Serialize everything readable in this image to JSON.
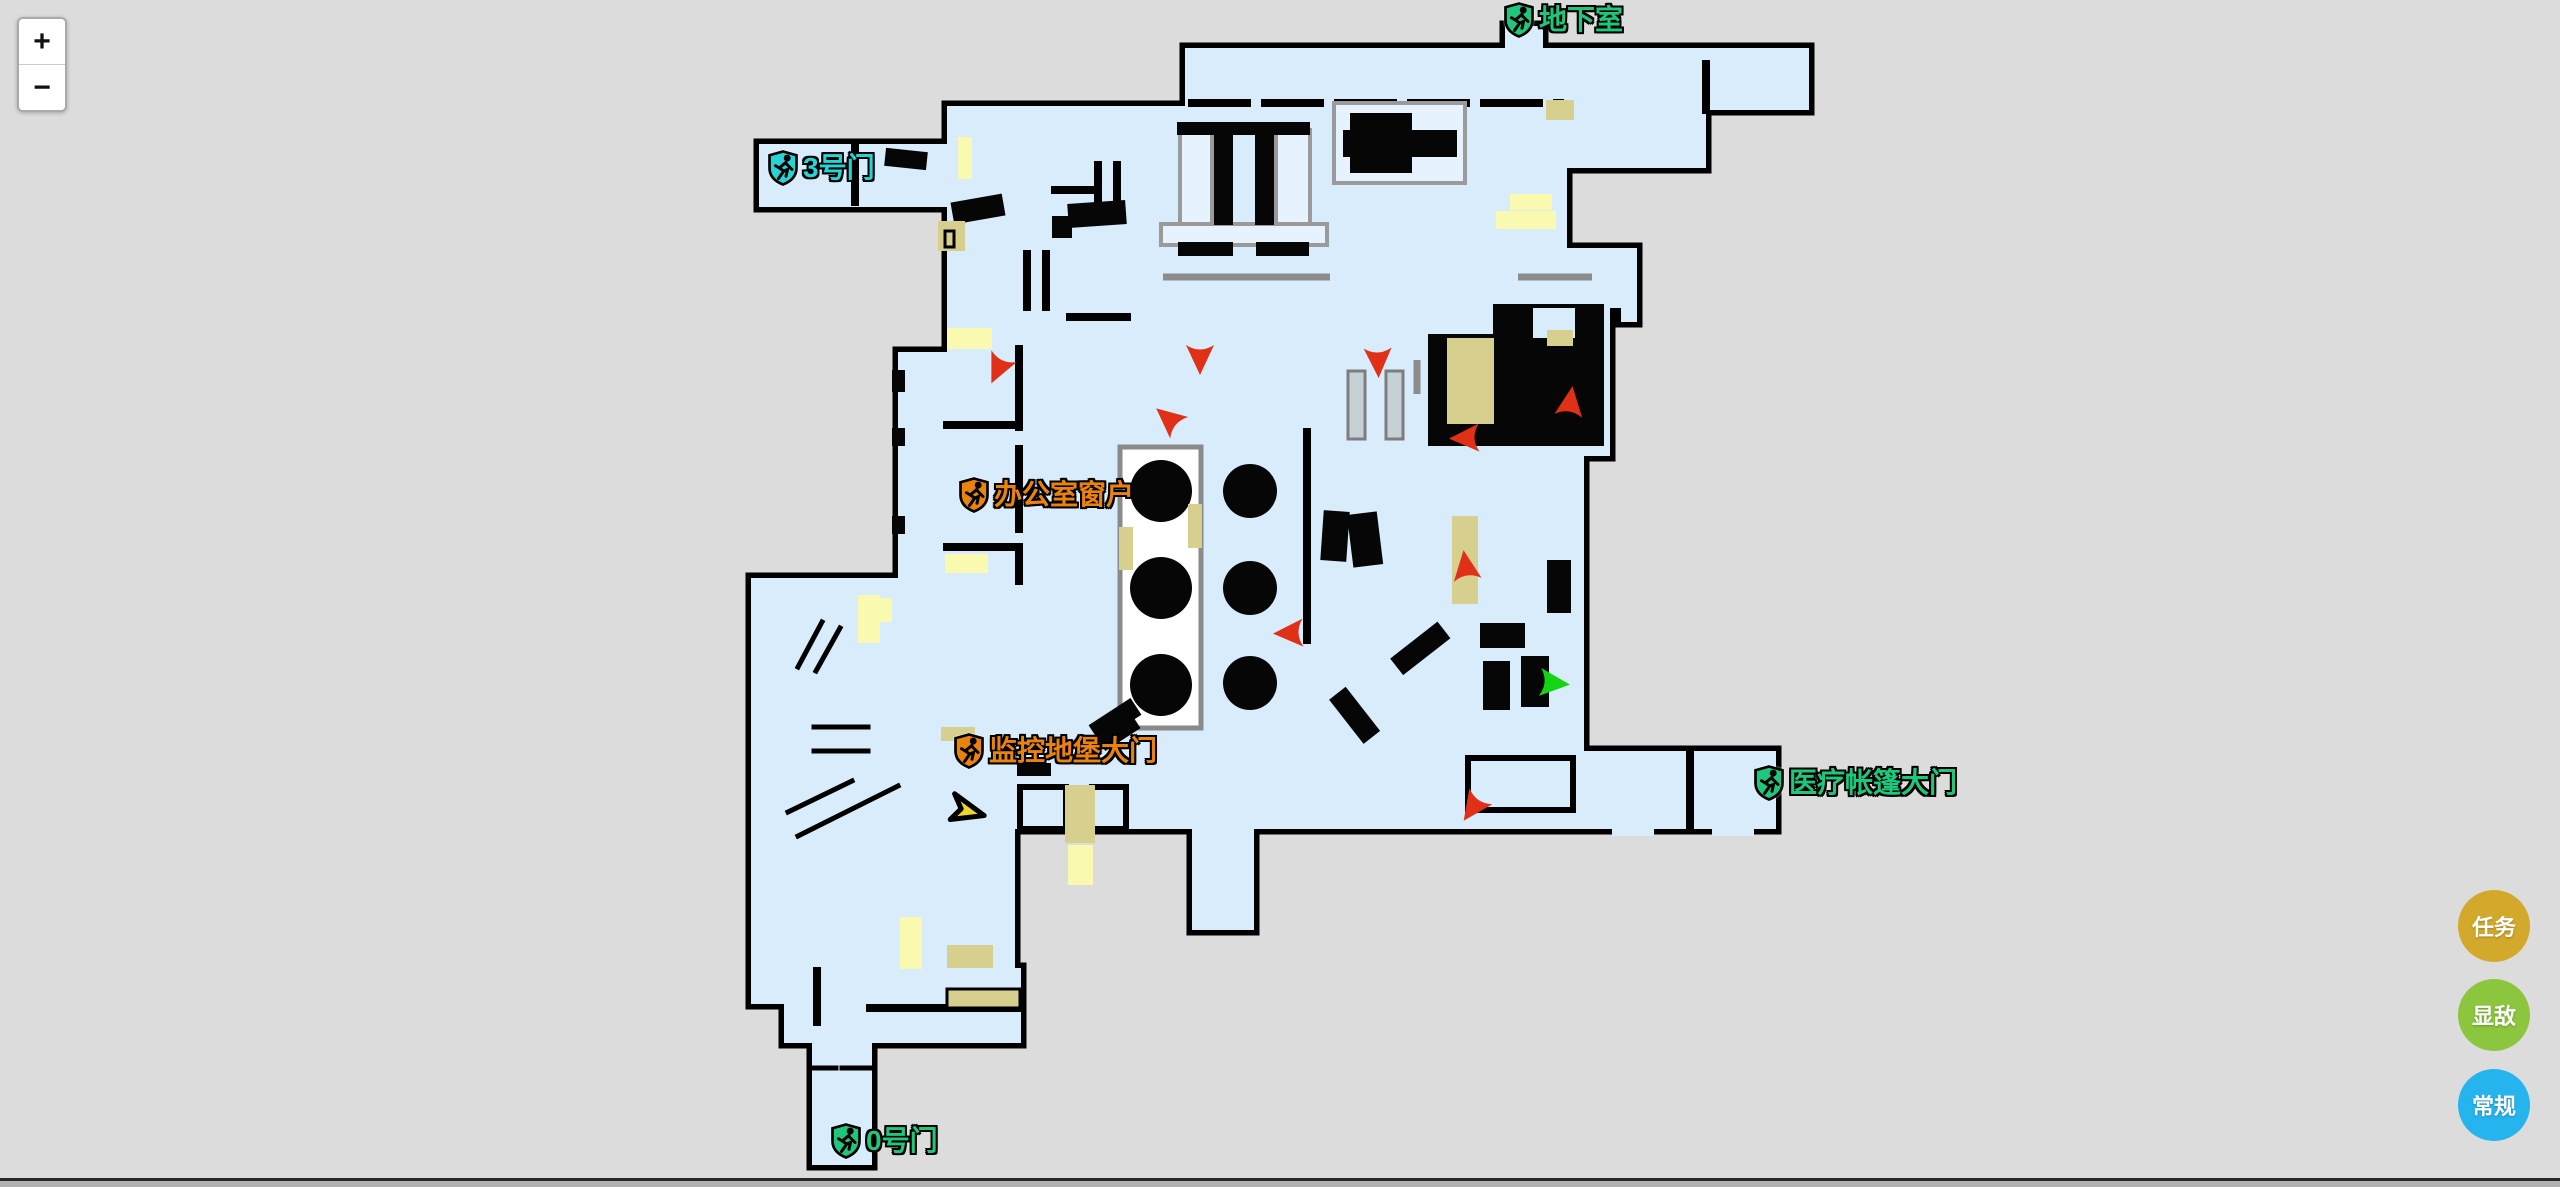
{
  "page": {
    "background": "#dcdcdc",
    "bottom_bar_color": "#b0b0b0"
  },
  "zoom_control": {
    "zoom_in": "+",
    "zoom_out": "−"
  },
  "map": {
    "colors": {
      "floor": "#d9ecfc",
      "wall": "#000000",
      "khaki": "#d7cf8e",
      "light_yellow": "#f9f9af",
      "exit_green": "#1ec77c",
      "exit_cyan": "#27d4d4",
      "exit_orange": "#ea830d"
    },
    "labels": [
      {
        "id": "basement-exit",
        "text": "地下室",
        "color": "#1ec77c",
        "x": 1504,
        "y": 2
      },
      {
        "id": "gate-3-exit",
        "text": "3号门",
        "color": "#27d4d4",
        "x": 768,
        "y": 150
      },
      {
        "id": "office-window-exit",
        "text": "办公室窗户",
        "color": "#ea830d",
        "x": 959,
        "y": 477
      },
      {
        "id": "bunker-gate-exit",
        "text": "监控地堡大门",
        "color": "#ea830d",
        "x": 954,
        "y": 733
      },
      {
        "id": "medical-tent-exit",
        "text": "医疗帐篷大门",
        "color": "#1ec77c",
        "x": 1754,
        "y": 765
      },
      {
        "id": "gate-0-exit",
        "text": "0号门",
        "color": "#1ec77c",
        "x": 831,
        "y": 1123
      }
    ],
    "markers": {
      "enemy_color": "#e03018",
      "ally_color": "#14d414",
      "player_color": "#efd52f",
      "enemies": [
        {
          "x": 999,
          "y": 367,
          "angle": 205
        },
        {
          "x": 1200,
          "y": 357,
          "angle": 180
        },
        {
          "x": 1378,
          "y": 360,
          "angle": 178
        },
        {
          "x": 1170,
          "y": 420,
          "angle": 310
        },
        {
          "x": 1467,
          "y": 438,
          "angle": 268
        },
        {
          "x": 1570,
          "y": 404,
          "angle": 8
        },
        {
          "x": 1466,
          "y": 568,
          "angle": 352
        },
        {
          "x": 1291,
          "y": 633,
          "angle": 268
        },
        {
          "x": 1474,
          "y": 806,
          "angle": 215
        }
      ],
      "allies": [
        {
          "x": 1552,
          "y": 683,
          "angle": 95
        }
      ],
      "player": {
        "x": 966,
        "y": 810,
        "angle": 14
      }
    }
  },
  "fab_buttons": [
    {
      "id": "tasks",
      "label": "任务",
      "color": "#d2a92b"
    },
    {
      "id": "show-enemies",
      "label": "显敌",
      "color": "#8cc63e"
    },
    {
      "id": "general",
      "label": "常规",
      "color": "#26b4ee"
    }
  ]
}
